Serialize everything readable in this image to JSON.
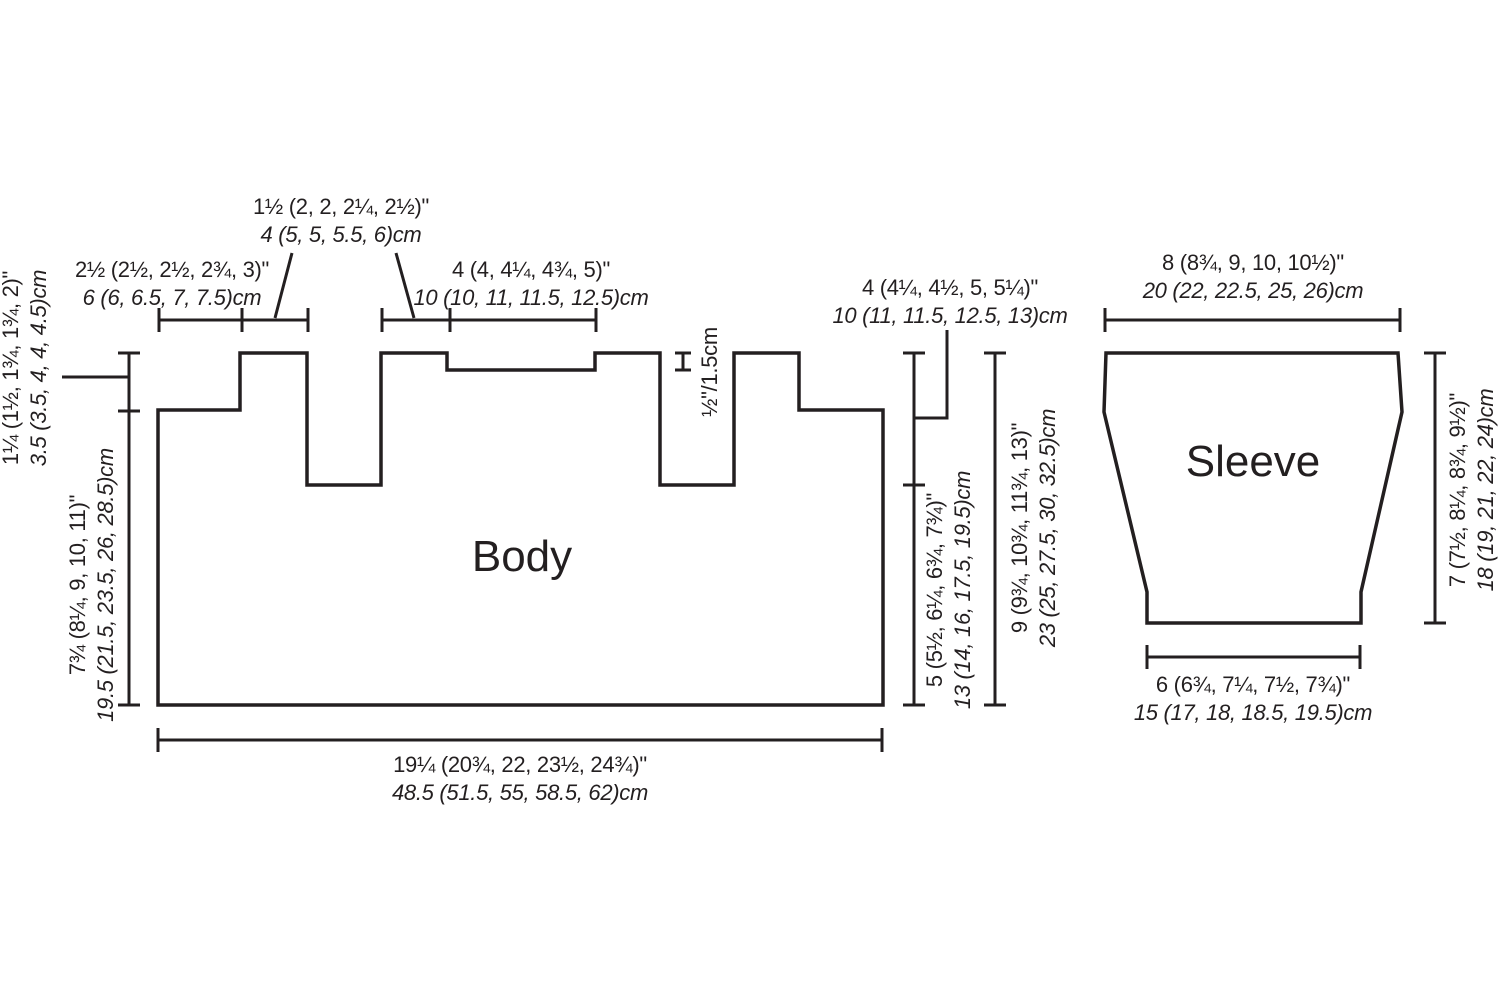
{
  "colors": {
    "ink": "#231f20",
    "background": "#ffffff"
  },
  "body": {
    "title": "Body",
    "top_left_width": {
      "in": "2½ (2½, 2½, 2¾, 3)\"",
      "cm": "6 (6, 6.5, 7, 7.5)cm"
    },
    "shoulder_width": {
      "in": "1½ (2, 2, 2¼, 2½)\"",
      "cm": "4 (5, 5, 5.5, 6)cm"
    },
    "top_right_width": {
      "in": "4 (4, 4¼, 4¾, 5)\"",
      "cm": "10 (10, 11, 11.5, 12.5)cm"
    },
    "neck_step": "½\"/1.5cm",
    "shoulder_drop": {
      "in": "1¼ (1½, 1¾, 1¾, 2)\"",
      "cm": "3.5 (3.5, 4, 4, 4.5)cm"
    },
    "left_length": {
      "in": "7¾ (8¼, 9, 10, 11)\"",
      "cm": "19.5 (21.5, 23.5, 26, 28.5)cm"
    },
    "armhole_depth": {
      "in": "4 (4¼, 4½, 5, 5¼)\"",
      "cm": "10 (11, 11.5, 12.5, 13)cm"
    },
    "below_armhole": {
      "in": "5 (5½, 6¼, 6¾, 7¾)\"",
      "cm": "13 (14, 16, 17.5, 19.5)cm"
    },
    "side_total": {
      "in": "9 (9¾, 10¾, 11¾, 13)\"",
      "cm": "23 (25, 27.5, 30, 32.5)cm"
    },
    "hem_width": {
      "in": "19¼ (20¾, 22, 23½, 24¾)\"",
      "cm": "48.5 (51.5, 55, 58.5, 62)cm"
    }
  },
  "sleeve": {
    "title": "Sleeve",
    "top_width": {
      "in": "8 (8¾, 9, 10, 10½)\"",
      "cm": "20 (22, 22.5, 25, 26)cm"
    },
    "cuff_width": {
      "in": "6 (6¾, 7¼, 7½, 7¾)\"",
      "cm": "15 (17, 18, 18.5, 19.5)cm"
    },
    "length": {
      "in": "7 (7½, 8¼, 8¾, 9½)\"",
      "cm": "18 (19, 21, 22, 24)cm"
    }
  }
}
